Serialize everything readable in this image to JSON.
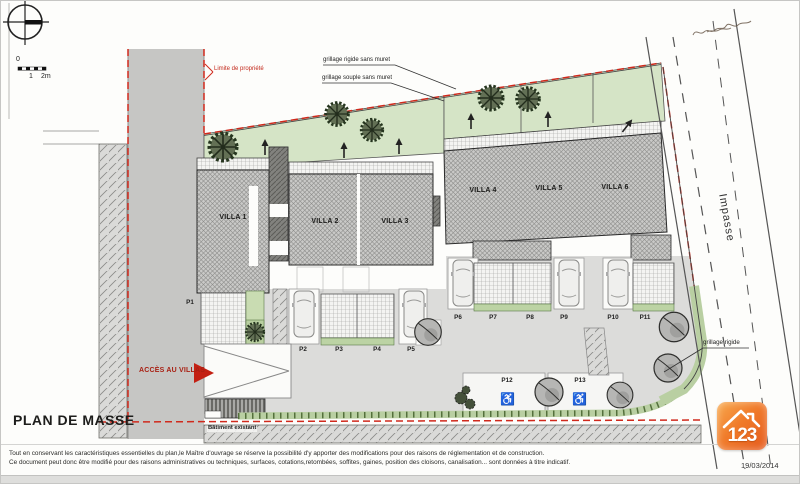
{
  "header": {
    "title": "PLAN DE MASSE",
    "date": "19/03/2014"
  },
  "scalebar": {
    "zero": "0",
    "one": "1",
    "two": "2m"
  },
  "annotations": {
    "limite_propriete": "Limite de propriété",
    "grillage_rigide_sans_muret": "grillage rigide sans muret",
    "grillage_souple_sans_muret": "grillage souple sans muret",
    "grillage_rigide": "grillage rigide",
    "acces_villas": "ACCÈS AU VILLAS",
    "impasse": "Impasse",
    "batiment_existant": "Bâtiment existant"
  },
  "villas": [
    {
      "label": "VILLA 1"
    },
    {
      "label": "VILLA 2"
    },
    {
      "label": "VILLA 3"
    },
    {
      "label": "VILLA 4"
    },
    {
      "label": "VILLA 5"
    },
    {
      "label": "VILLA 6"
    }
  ],
  "parkings": [
    {
      "label": "P1"
    },
    {
      "label": "P2"
    },
    {
      "label": "P3"
    },
    {
      "label": "P4"
    },
    {
      "label": "P5"
    },
    {
      "label": "P6"
    },
    {
      "label": "P7"
    },
    {
      "label": "P8"
    },
    {
      "label": "P9"
    },
    {
      "label": "P10"
    },
    {
      "label": "P11"
    },
    {
      "label": "P12"
    },
    {
      "label": "P13"
    }
  ],
  "icons": {
    "wheelchair": "♿"
  },
  "footer": {
    "line1": "Tout en conservant les caractéristiques essentielles du plan,le Maître d'ouvrage se réserve la possibilité d'y apporter des modifications pour des raisons de réglementation et de construction.",
    "line2": "Ce document peut donc être modifié pour des raisons administratives ou techniques, surfaces, cotations,retombées, soffites, gaines, position des cloisons, canalisation... sont données à titre indicatif."
  },
  "logo": {
    "text": "123"
  },
  "colors": {
    "property_line": "#d0291c",
    "garden": "#d5e4c6",
    "accent": "#ed6d1f",
    "road": "#c6c6c4",
    "courtyard": "#dcdcda"
  }
}
